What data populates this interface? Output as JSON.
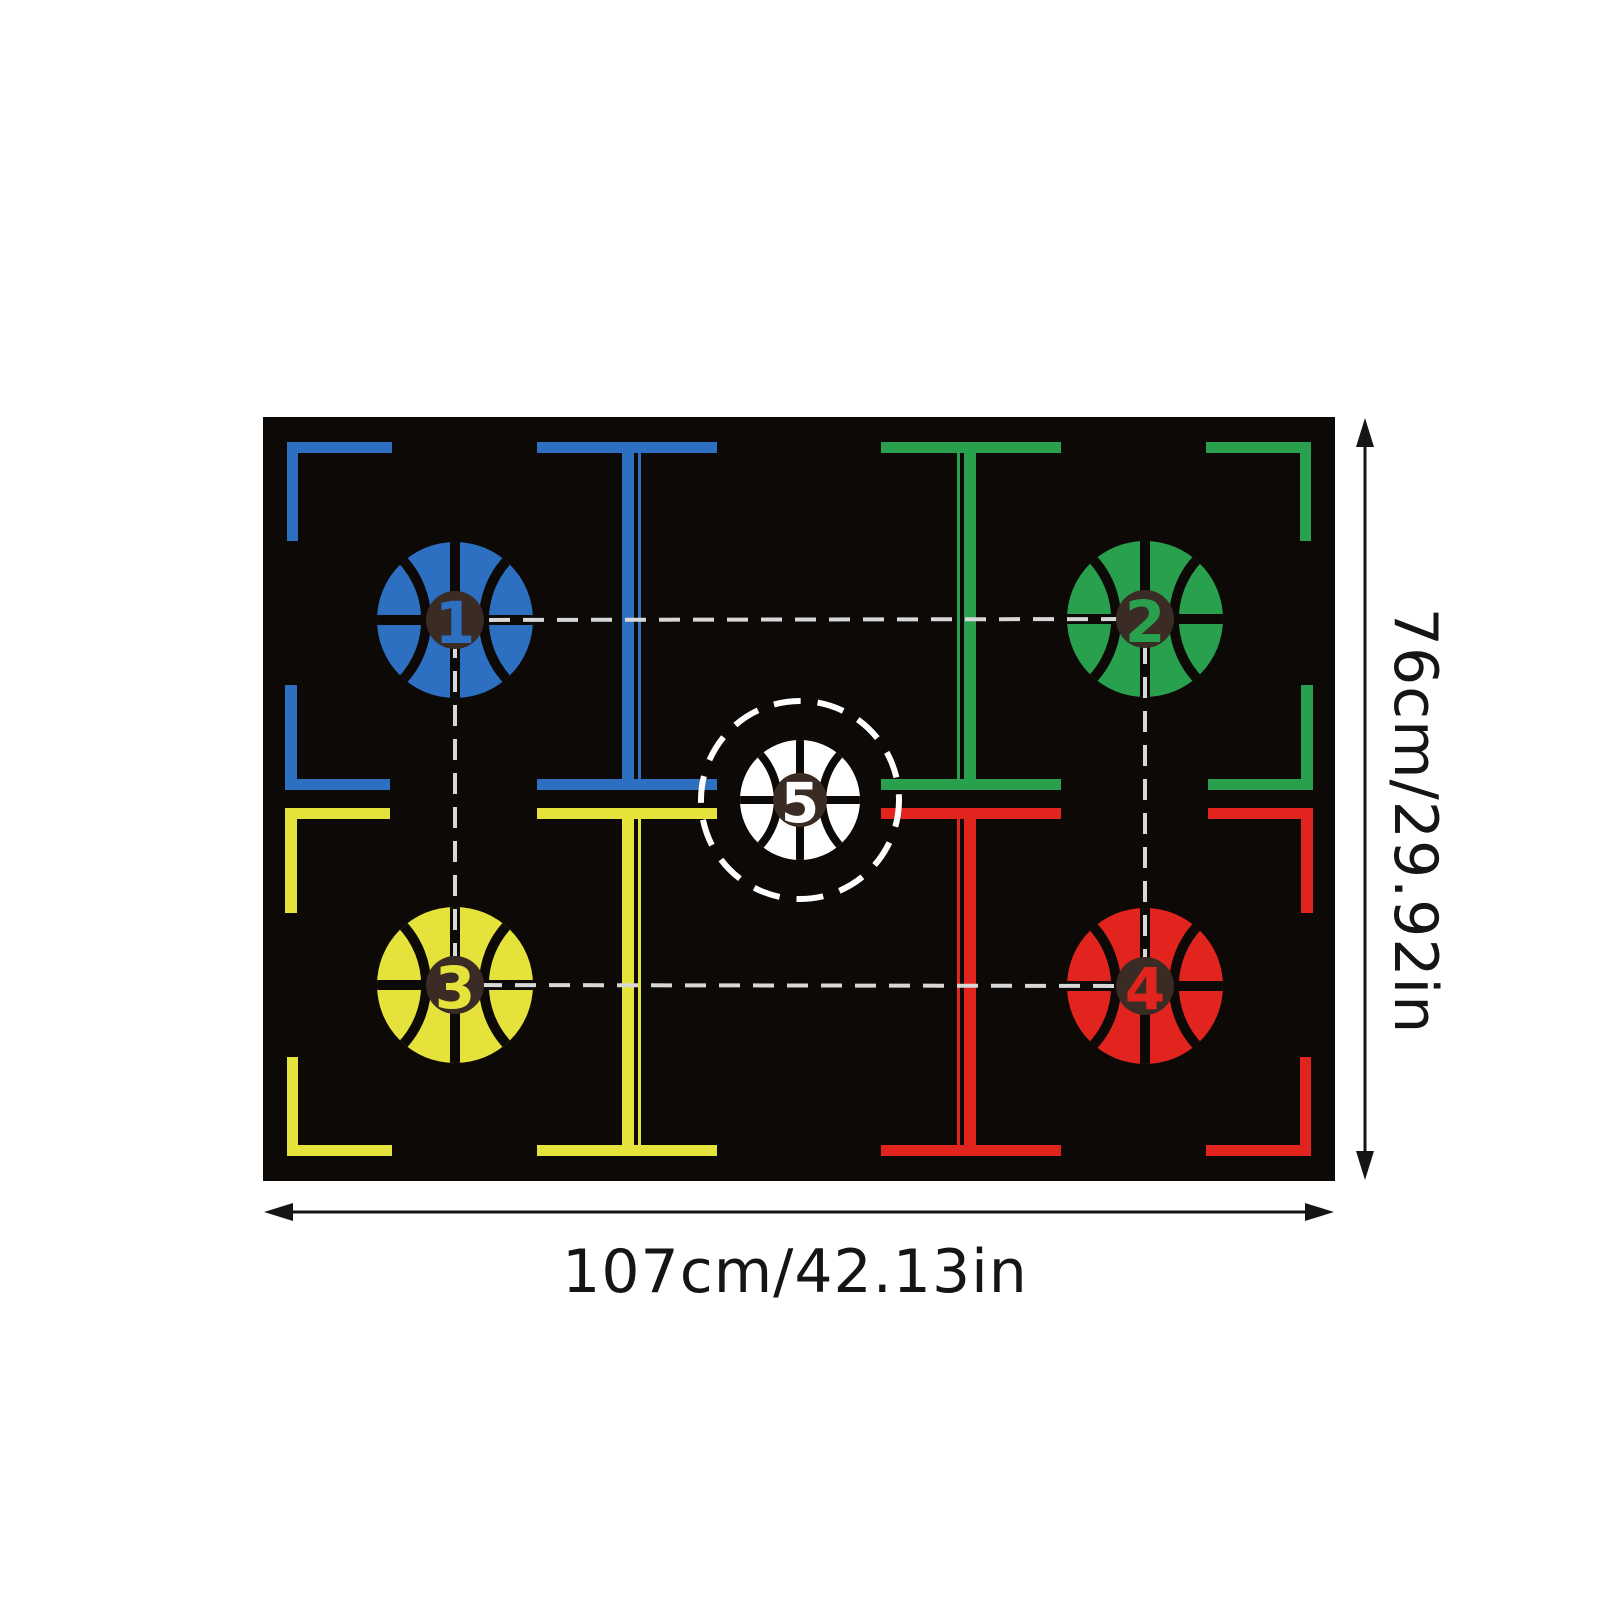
{
  "page": {
    "background": "#ffffff"
  },
  "mat": {
    "background": "#0c0907",
    "seam_color": "#0c0907",
    "badge_color": "#3a2b24",
    "dash_color": "#d8d8d8",
    "ring_color": "#ffffff",
    "quadrants": [
      {
        "id": "top-left",
        "color": "#2d70c2"
      },
      {
        "id": "top-right",
        "color": "#28a04d"
      },
      {
        "id": "bottom-left",
        "color": "#e6e23c"
      },
      {
        "id": "bottom-right",
        "color": "#e1251e"
      }
    ],
    "markers": [
      {
        "number": "1",
        "color": "#2d70c2",
        "position": "top-left",
        "dashed_ring": false
      },
      {
        "number": "2",
        "color": "#28a04d",
        "position": "top-right",
        "dashed_ring": false
      },
      {
        "number": "3",
        "color": "#e6e23c",
        "position": "bottom-left",
        "dashed_ring": false
      },
      {
        "number": "4",
        "color": "#e1251e",
        "position": "bottom-right",
        "dashed_ring": false
      },
      {
        "number": "5",
        "color": "#ffffff",
        "position": "center",
        "dashed_ring": true
      }
    ]
  },
  "dimensions": {
    "width_label": "107cm/42.13in",
    "height_label": "76cm/29.92in",
    "arrow_color": "#151515",
    "text_color": "#151515"
  }
}
